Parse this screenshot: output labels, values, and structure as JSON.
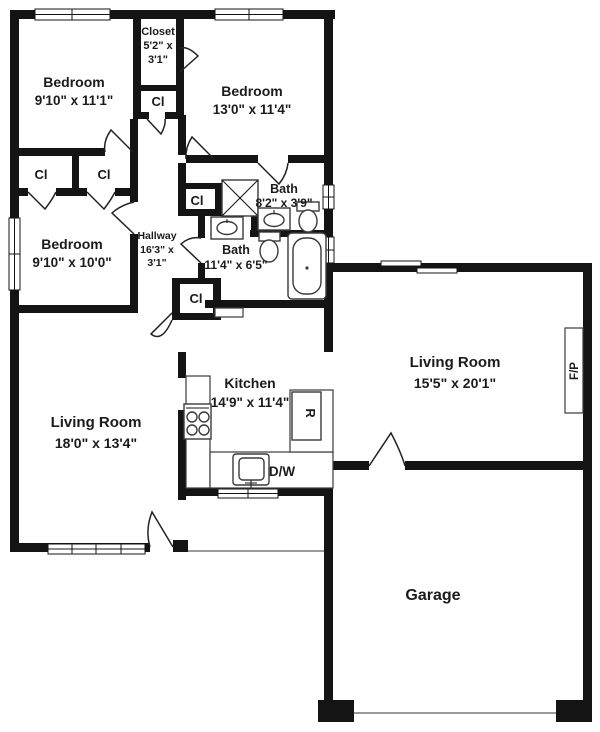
{
  "colors": {
    "wall": "#141414",
    "background": "#ffffff",
    "fixture_outline": "#3a3a3a"
  },
  "rooms": {
    "bedroom_top_left": {
      "name": "Bedroom",
      "dims": "9'10\" x 11'1\""
    },
    "bedroom_top_right": {
      "name": "Bedroom",
      "dims": "13'0\" x 11'4\""
    },
    "bedroom_left": {
      "name": "Bedroom",
      "dims": "9'10\" x 10'0\""
    },
    "closet_top": {
      "name": "Closet",
      "dims_line1": "5'2\" x",
      "dims_line2": "3'1\""
    },
    "hallway": {
      "name": "Hallway",
      "dims_line1": "16'3\" x",
      "dims_line2": "3'1\""
    },
    "bath_small": {
      "name": "Bath",
      "dims": "8'2\" x 3'9\""
    },
    "bath_large": {
      "name": "Bath",
      "dims": "11'4\" x 6'5\""
    },
    "living_right": {
      "name": "Living Room",
      "dims": "15'5\" x 20'1\""
    },
    "living_left": {
      "name": "Living Room",
      "dims": "18'0\" x 13'4\""
    },
    "kitchen": {
      "name": "Kitchen",
      "dims": "14'9\" x 11'4\""
    },
    "garage": {
      "name": "Garage"
    }
  },
  "abbrev": {
    "closet": "Cl",
    "dishwasher": "D/W",
    "refrigerator": "R",
    "fireplace": "F/P"
  }
}
